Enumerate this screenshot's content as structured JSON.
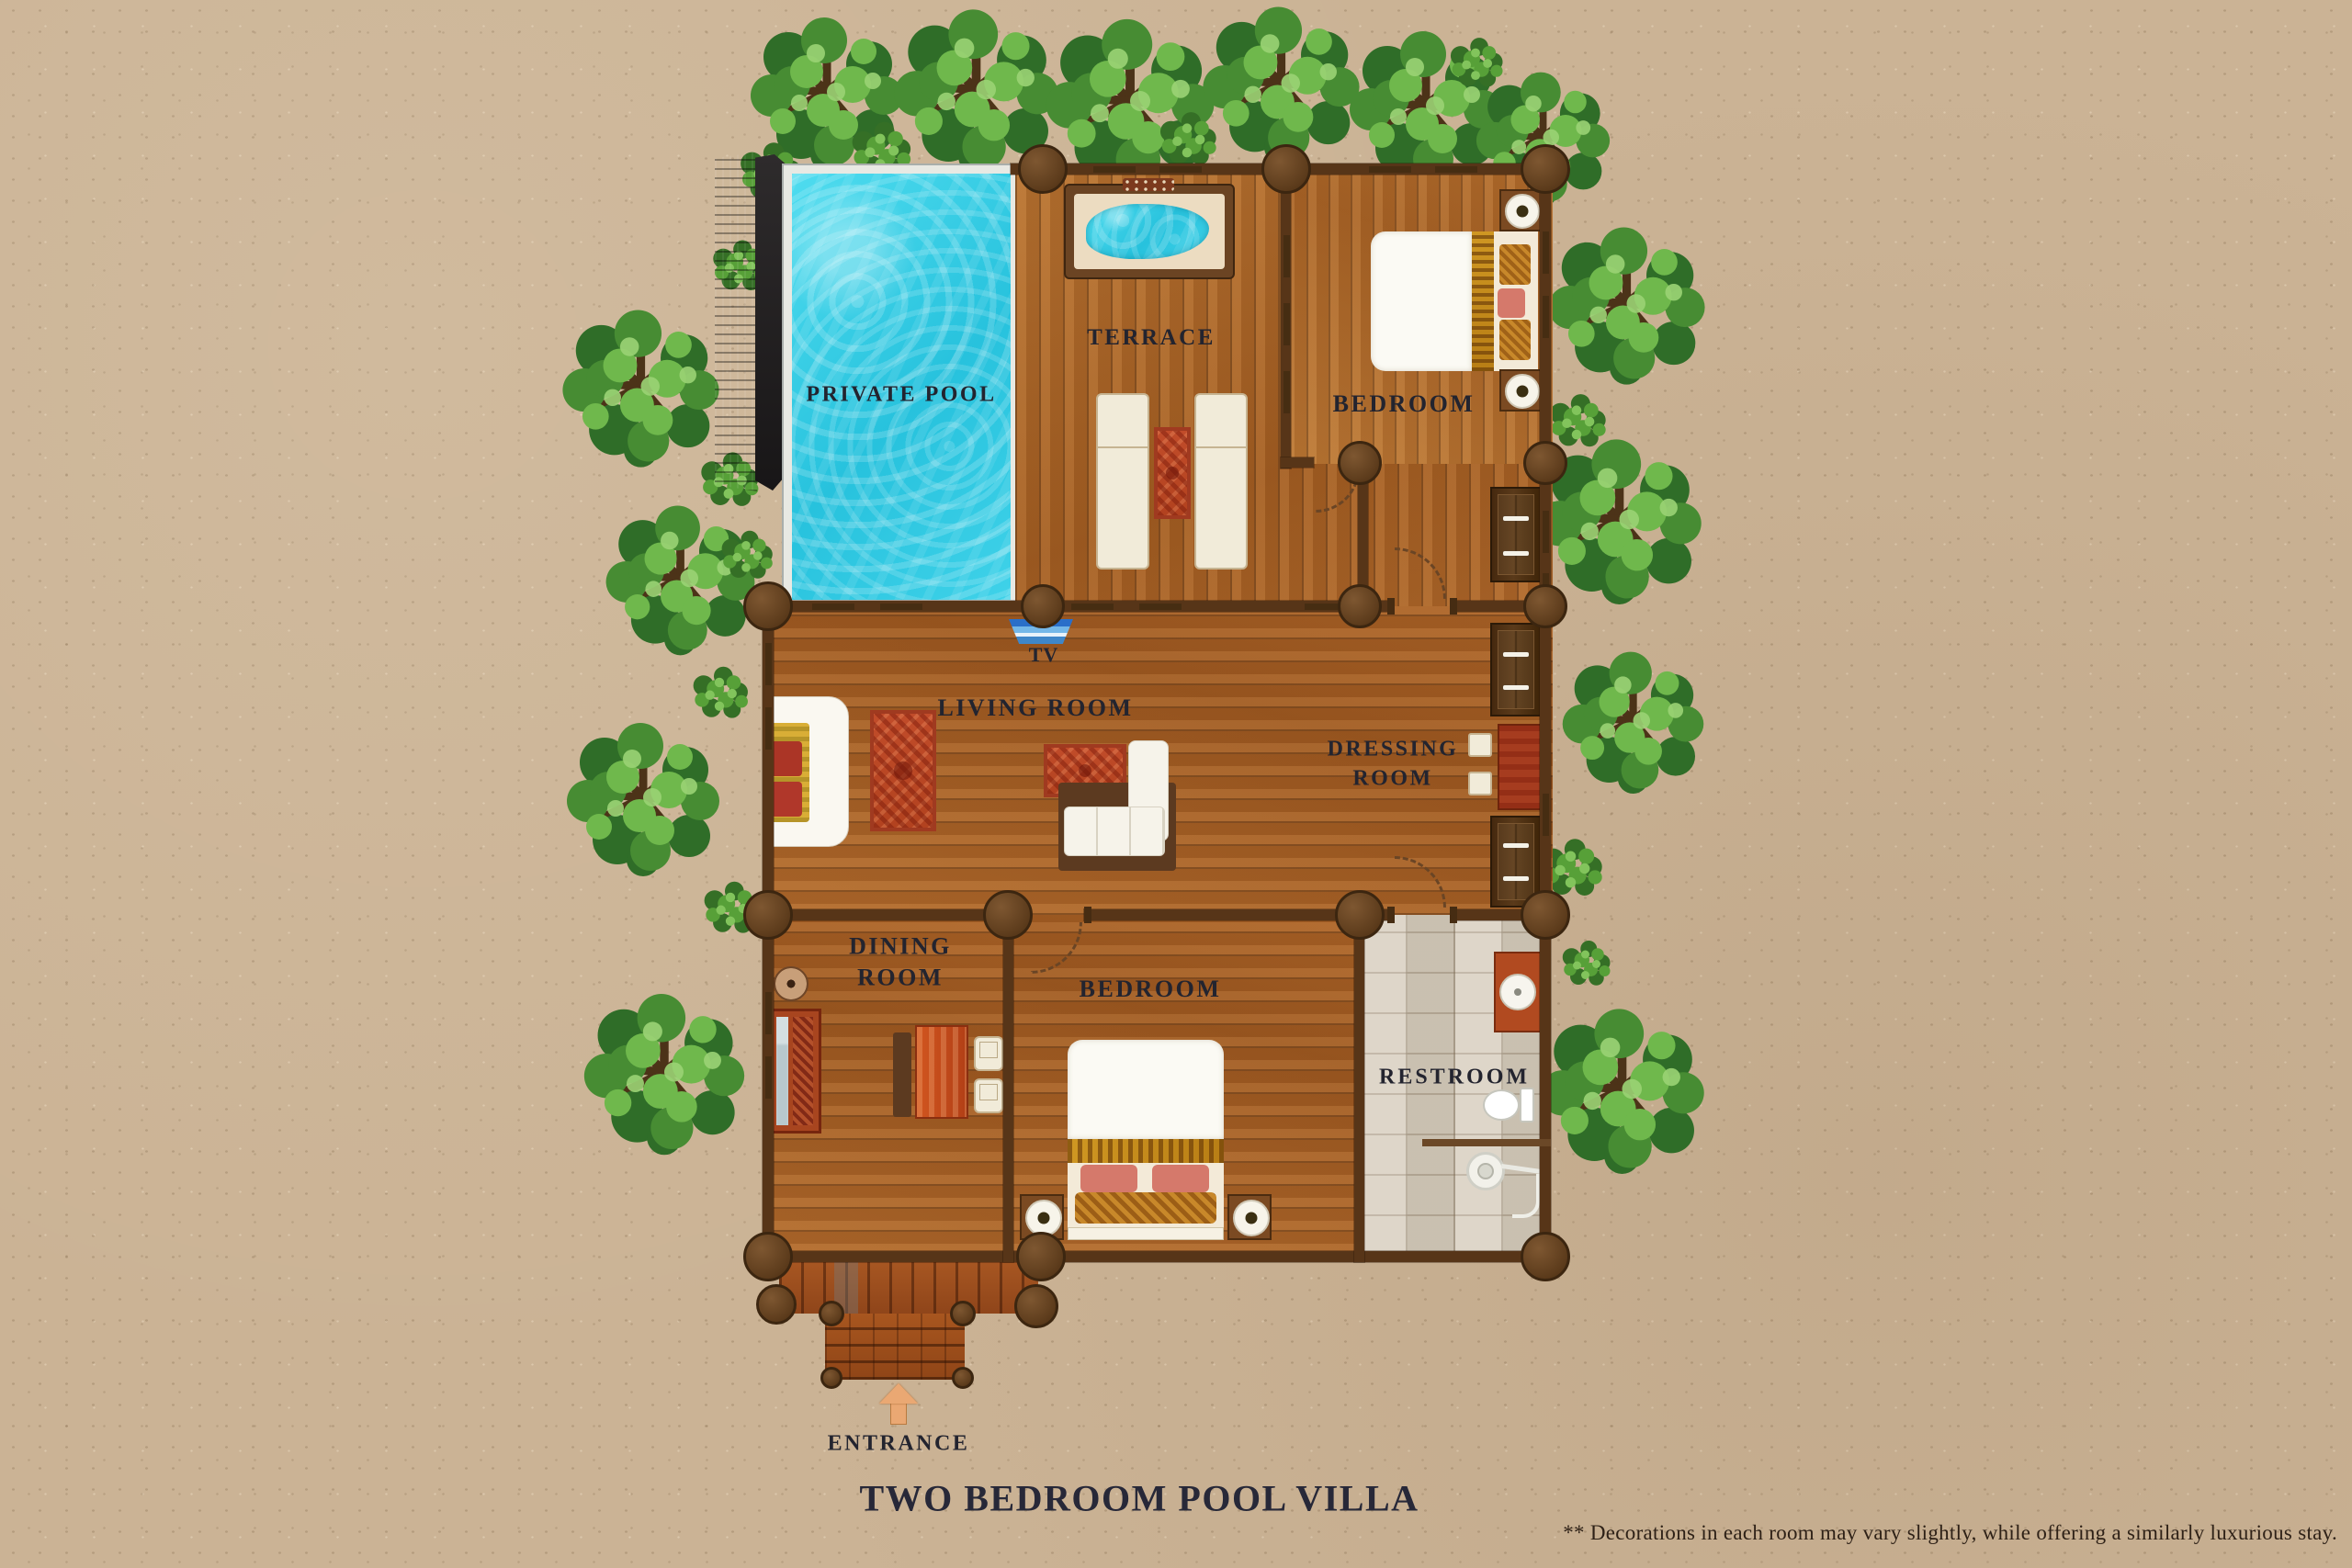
{
  "page": {
    "title": "TWO BEDROOM POOL VILLA",
    "disclaimer": "** Decorations in each room may vary slightly, while offering a similarly luxurious stay."
  },
  "labels": {
    "private_pool": "PRIVATE POOL",
    "terrace": "TERRACE",
    "bedroom_top": "BEDROOM",
    "tv": "TV",
    "living_room": "LIVING ROOM",
    "dressing_room": "DRESSING ROOM",
    "dining_room": "DINING ROOM",
    "bedroom_bottom": "BEDROOM",
    "restroom": "RESTROOM",
    "entrance": "ENTRANCE"
  },
  "icons": {
    "entrance_arrow": "arrow-up-icon"
  },
  "colors": {
    "sand": "#cbb395",
    "pool_water": "#2fc9e2",
    "wood_deck": "#b06a2c",
    "entrance_wood": "#a3531c",
    "wall_brown": "#573518",
    "tree_green": "#478c33",
    "rug_red": "#b2421f",
    "restroom_tile": "#d8cfc0",
    "label_text": "#23242f"
  }
}
